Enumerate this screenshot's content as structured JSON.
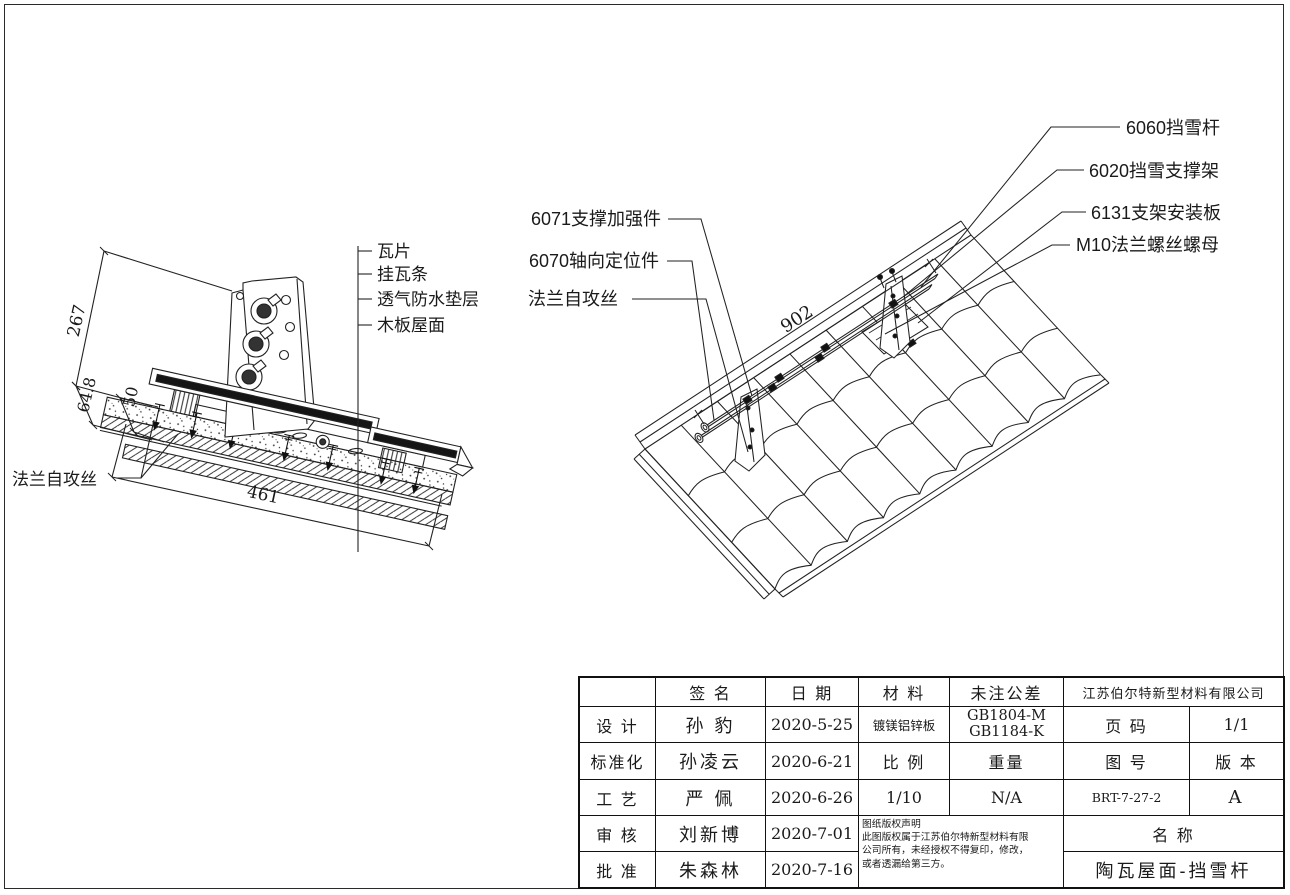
{
  "left_view": {
    "part_labels": [
      "瓦片",
      "挂瓦条",
      "透气防水垫层",
      "木板屋面"
    ],
    "screw_label": "法兰自攻丝",
    "dimensions": {
      "slope_height": "267",
      "offset_a": "64.8",
      "offset_b": "50",
      "width": "461"
    }
  },
  "right_view": {
    "labels_right": [
      "6060挡雪杆",
      "6020挡雪支撑架",
      "6131支架安装板",
      "M10法兰螺丝螺母"
    ],
    "labels_left": [
      "6071支撑加强件",
      "6070轴向定位件",
      "法兰自攻丝"
    ],
    "dimension": "902"
  },
  "title_block": {
    "company": "江苏伯尔特新型材料有限公司",
    "headers": {
      "signature": "签 名",
      "date": "日 期",
      "material": "材 料",
      "tolerance": "未注公差"
    },
    "rows": [
      {
        "role": "设 计",
        "name": "孙  豹",
        "date": "2020-5-25"
      },
      {
        "role": "标准化",
        "name": "孙凌云",
        "date": "2020-6-21"
      },
      {
        "role": "工 艺",
        "name": "严  佩",
        "date": "2020-6-26"
      },
      {
        "role": "审 核",
        "name": "刘新博",
        "date": "2020-7-01"
      },
      {
        "role": "批 准",
        "name": "朱森林",
        "date": "2020-7-16"
      }
    ],
    "material_value": "镀镁铝锌板",
    "tolerance_value_1": "GB1804-M",
    "tolerance_value_2": "GB1184-K",
    "page_label": "页 码",
    "page_value": "1/1",
    "scale_label": "比 例",
    "scale_value": "1/10",
    "weight_label": "重量",
    "weight_value": "N/A",
    "drawing_no_label": "图 号",
    "drawing_no_value": "BRT-7-27-2",
    "version_label": "版 本",
    "version_value": "A",
    "name_label": "名 称",
    "name_value": "陶瓦屋面-挡雪杆",
    "copyright": [
      "图纸版权声明",
      "此图版权属于江苏伯尔特新型材料有限",
      "公司所有，未经授权不得复印，修改，",
      "或者透漏给第三方。"
    ]
  }
}
